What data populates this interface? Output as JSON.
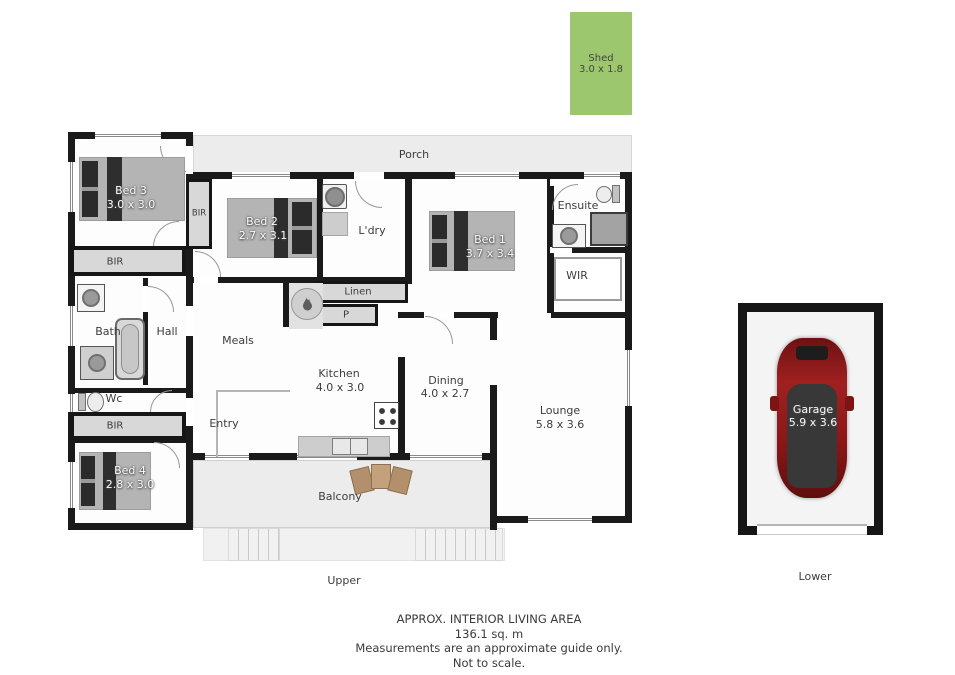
{
  "plan": {
    "shed": {
      "name": "Shed",
      "dims": "3.0 x 1.8"
    },
    "rooms": {
      "porch": {
        "name": "Porch"
      },
      "bed3": {
        "name": "Bed 3",
        "dims": "3.0 x 3.0"
      },
      "bed2": {
        "name": "Bed 2",
        "dims": "2.7 x 3.1"
      },
      "bed1": {
        "name": "Bed 1",
        "dims": "3.7 x 3.4"
      },
      "bed4": {
        "name": "Bed 4",
        "dims": "2.8 x 3.0"
      },
      "kitchen": {
        "name": "Kitchen",
        "dims": "4.0 x 3.0"
      },
      "dining": {
        "name": "Dining",
        "dims": "4.0 x 2.7"
      },
      "lounge": {
        "name": "Lounge",
        "dims": "5.8 x 3.6"
      },
      "garage": {
        "name": "Garage",
        "dims": "5.9 x 3.6"
      },
      "ldry": {
        "name": "L'dry"
      },
      "ensuite": {
        "name": "Ensuite"
      },
      "wir": {
        "name": "WIR"
      },
      "bath": {
        "name": "Bath"
      },
      "hall": {
        "name": "Hall"
      },
      "meals": {
        "name": "Meals"
      },
      "entry": {
        "name": "Entry"
      },
      "wc": {
        "name": "Wc"
      },
      "linen": {
        "name": "Linen"
      },
      "pantry": {
        "name": "P"
      },
      "balcony": {
        "name": "Balcony"
      },
      "bir_side": {
        "name": "BIR"
      },
      "bir_top": {
        "name": "BIR"
      },
      "bir_lower": {
        "name": "BIR"
      }
    },
    "levels": {
      "upper": "Upper",
      "lower": "Lower"
    }
  },
  "footer": {
    "line1": "APPROX. INTERIOR LIVING AREA",
    "line2": "136.1 sq. m",
    "line3": "Measurements are an approximate guide only.",
    "line4": "Not to scale."
  },
  "colors": {
    "wall": "#1a1a1a",
    "shed_green": "#9cc76f",
    "outdoor_gray": "#ececec",
    "car_red": "#8c1717",
    "label_gray": "#3d3d3d"
  }
}
